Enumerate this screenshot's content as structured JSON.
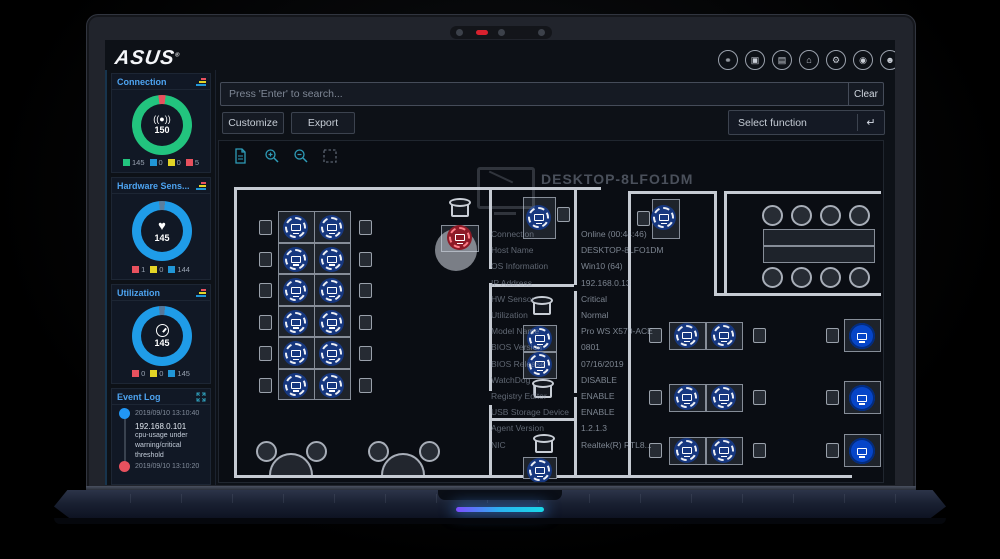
{
  "brand": {
    "logo_text": "ASUS",
    "registered_mark": "®"
  },
  "topbar": {
    "icons": [
      {
        "name": "remote-link-icon",
        "glyph": "⚭"
      },
      {
        "name": "snapshot-icon",
        "glyph": "▣"
      },
      {
        "name": "server-list-icon",
        "glyph": "▤"
      },
      {
        "name": "organization-icon",
        "glyph": "⌂"
      },
      {
        "name": "settings-icon",
        "glyph": "⚙"
      },
      {
        "name": "security-icon",
        "glyph": "◉"
      },
      {
        "name": "account-icon",
        "glyph": "☻"
      }
    ]
  },
  "search": {
    "placeholder": "Press 'Enter' to search...",
    "clear_label": "Clear"
  },
  "actions": {
    "customize": "Customize",
    "export": "Export",
    "select_function": "Select function",
    "return_icon_glyph": "↵"
  },
  "map_toolbar": {
    "icons": [
      "floor-plan-icon",
      "zoom-in-icon",
      "zoom-out-icon",
      "marquee-select-icon"
    ],
    "accent_color": "#2e9cb8"
  },
  "widgets": {
    "connection": {
      "title": "Connection",
      "center_value": "150",
      "center_icon": "((●))",
      "ring": {
        "main": "#22c47e",
        "alert": "#e8515e"
      },
      "legend": [
        {
          "color": "#22c47e",
          "value": "145"
        },
        {
          "color": "#2196d6",
          "value": "0"
        },
        {
          "color": "#e3d426",
          "value": "0"
        },
        {
          "color": "#e8515e",
          "value": "5"
        }
      ]
    },
    "hardware_sensor": {
      "title": "Hardware Sens...",
      "center_value": "145",
      "center_icon": "♥",
      "ring": {
        "main": "#1f9ce8",
        "notch": "#5b7f9e"
      },
      "legend": [
        {
          "color": "#e8515e",
          "value": "1"
        },
        {
          "color": "#e3d426",
          "value": "0"
        },
        {
          "color": "#2196d6",
          "value": "144"
        }
      ]
    },
    "utilization": {
      "title": "Utilization",
      "center_value": "145",
      "ring": {
        "main": "#1f9ce8",
        "notch": "#56789a"
      },
      "legend": [
        {
          "color": "#e8515e",
          "value": "0"
        },
        {
          "color": "#e3d426",
          "value": "0"
        },
        {
          "color": "#2196d6",
          "value": "145"
        }
      ]
    },
    "event_log": {
      "title": "Event Log",
      "entries": [
        {
          "dot_color": "#2196f3",
          "timestamp": "2019/09/10 13:10:40",
          "lines": [
            "192.168.0.101",
            "cpu-usage       under",
            "warning/critical",
            "threshold"
          ]
        },
        {
          "dot_color": "#e8515e",
          "timestamp": "2019/09/10 13:10:20",
          "lines": []
        }
      ]
    }
  },
  "device_tooltip": {
    "title": "DESKTOP-8LFO1DM",
    "fields": [
      {
        "label": "Connection",
        "value": "Online (00:44:46)"
      },
      {
        "label": "Host Name",
        "value": "DESKTOP-8LFO1DM"
      },
      {
        "label": "OS Information",
        "value": "Win10 (64)"
      },
      {
        "label": "IP Address",
        "value": "192.168.0.13"
      },
      {
        "label": "HW Sensor",
        "value": "Critical"
      },
      {
        "label": "Utilization",
        "value": "Normal"
      },
      {
        "label": "Model Name",
        "value": "Pro WS X570-ACE"
      },
      {
        "label": "BIOS Version",
        "value": "0801"
      },
      {
        "label": "BIOS Release",
        "value": "07/16/2019"
      },
      {
        "label": "WatchDog",
        "value": "DISABLE"
      },
      {
        "label": "Registry Editor",
        "value": "ENABLE"
      },
      {
        "label": "USB Storage Device",
        "value": "ENABLE"
      },
      {
        "label": "Agent Version",
        "value": "1.2.1.3"
      },
      {
        "label": "NIC",
        "value": "Realtek(R) RTL8..."
      }
    ]
  },
  "floor_plan": {
    "device_states": {
      "normal_color": "#16377f",
      "critical_color": "#8d1a26",
      "display_color": "#0645c8"
    },
    "selected_device_state": "critical"
  }
}
